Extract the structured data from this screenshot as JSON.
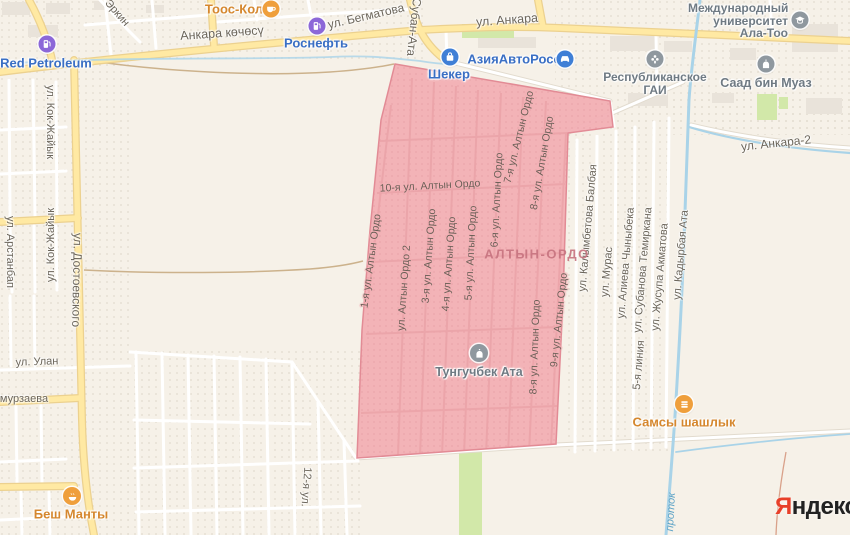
{
  "colors": {
    "bg": "#f6f1e8",
    "road-yellow": "#ffe9a3",
    "road-casing": "#ecd18f",
    "road-white": "#ffffff",
    "road-white-casing": "#e2dbce",
    "water": "#a9d3e8",
    "water-label": "#5ea3c6",
    "selection-fill": "#f3b0b5",
    "selection-border": "#e28b95",
    "selection-street": "#eba4a9",
    "selection-label": "#6a5f56",
    "green-area": "#d2e8a9",
    "building": "#e9e3da",
    "street-label": "#6b655a",
    "district-label": "#c7737f",
    "dirt": "#ccb28c",
    "dirt-red": "#d9a18a",
    "poi-orange": "#ef9f3c",
    "poi-orange-text": "#d5872e",
    "poi-blue": "#3f7fd6",
    "poi-blue-text": "#3a6fc4",
    "poi-purple": "#8c68d8",
    "poi-gray": "#8f989f",
    "poi-gray-text": "#6f7a83",
    "logo-red": "#e8402a",
    "logo-black": "#222222"
  },
  "district": {
    "label": "АЛТЫН-ОРДО"
  },
  "water": {
    "label": "проток"
  },
  "logo": {
    "first_letter": "Я",
    "rest": "ндекс"
  },
  "streets": [
    {
      "text": "Эркин"
    },
    {
      "text": "Анкара көчөсү"
    },
    {
      "text": "ул. Бегматова"
    },
    {
      "text": "Субан-Ата"
    },
    {
      "text": "ул. Анкара"
    },
    {
      "text": "ул. Анкара-2"
    },
    {
      "text": "ул. Кок-Жайык"
    },
    {
      "text": "ул. Кок-Жайык"
    },
    {
      "text": "ул. Арстанбап"
    },
    {
      "text": "ул. Достоевского"
    },
    {
      "text": "ул. Улан"
    },
    {
      "text": "мурзаева"
    },
    {
      "text": "12-я ул."
    },
    {
      "text": "1-я ул. Алтын Ордо"
    },
    {
      "text": "ул. Алтын Ордо 2"
    },
    {
      "text": "3-я ул. Алтын Ордо"
    },
    {
      "text": "4-я ул. Алтын Ордо"
    },
    {
      "text": "5-я ул. Алтын Ордо"
    },
    {
      "text": "6-я ул. Алтын Ордо"
    },
    {
      "text": "7-я ул. Алтын Ордо"
    },
    {
      "text": "8-я ул. Алтын Ордо"
    },
    {
      "text": "8-я ул. Алтын Ордо"
    },
    {
      "text": "9-я ул. Алтын Ордо"
    },
    {
      "text": "10-я ул. Алтын Ордо"
    },
    {
      "text": "ул. Калымбетова Балбая"
    },
    {
      "text": "ул. Мурас"
    },
    {
      "text": "ул. Алиева Чыныбека"
    },
    {
      "text": "ул. Субанова Темиркана"
    },
    {
      "text": "5-я линия"
    },
    {
      "text": "ул. Жусупа Акматова"
    },
    {
      "text": "ул. Кадырбая Ата"
    }
  ],
  "pois": [
    {
      "label": "Тоос-Кол",
      "icon": "cafe-icon"
    },
    {
      "label": "Роснефть",
      "icon": "fuel-icon"
    },
    {
      "label": "Red Petroleum",
      "icon": "fuel-icon"
    },
    {
      "label": "Шекер",
      "icon": "shop-icon"
    },
    {
      "label": "АзияАвтоРосс",
      "icon": "car-icon"
    },
    {
      "label_line1": "Республиканское",
      "label_line2": "ГАИ",
      "icon": "traffic-light-icon"
    },
    {
      "label": "Саад бин Муаз",
      "icon": "mosque-icon"
    },
    {
      "label_line1": "Международный",
      "label_line2": "университет",
      "label_line3": "Ала-Тоо",
      "icon": "university-icon"
    },
    {
      "label": "Тунгучбек Ата",
      "icon": "mosque-icon"
    },
    {
      "label": "Самсы шашлык",
      "icon": "food-icon"
    },
    {
      "label": "Беш Манты",
      "icon": "food-icon"
    }
  ]
}
